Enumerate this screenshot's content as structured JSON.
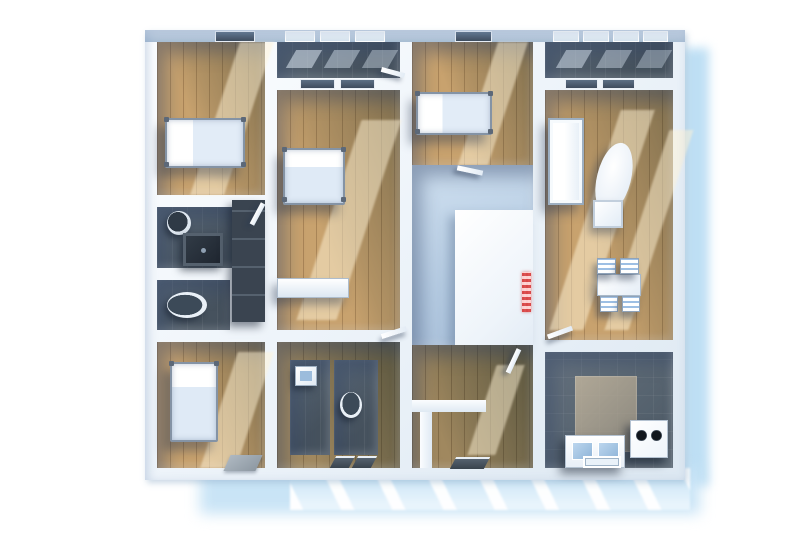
{
  "scene": {
    "kind": "3d-floor-plan-render",
    "view": "top-down perspective",
    "description": "Architectural 3D rendering of an apartment floor plan with white walls, wooden floors, dark tiled bathrooms and a soft blue drop shadow on white background"
  },
  "palette": {
    "background": "#ffffff",
    "drop_shadow": "#bedff4",
    "terrace": "#c9e4f6",
    "walls": "#eef4fa",
    "wall_face": "#b0c3d8",
    "wood_floor": "#c8a26e",
    "wood_floor_shadow": "#8b7f5e",
    "bathroom_floor": "#4e5b68",
    "hall_floor": "#b5cbe2",
    "kitchen_floor": "#5a6874",
    "window_dark": "#46566a",
    "window_bright": "#e6eef6",
    "accent_red": "#d63c3c",
    "furniture_white": "#f5f9fe",
    "mattress_blue": "#dce9f6"
  },
  "rooms": [
    {
      "name": "bedroom top-left",
      "floor": "wood",
      "furniture": [
        "single bed",
        "window"
      ]
    },
    {
      "name": "bathroom left",
      "floor": "dark tile",
      "furniture": [
        "round washbasin",
        "shower tray"
      ]
    },
    {
      "name": "wc left",
      "floor": "dark tile",
      "furniture": [
        "toilet"
      ]
    },
    {
      "name": "wardrobe closet",
      "floor": "dark",
      "furniture": [
        "built-in closet"
      ]
    },
    {
      "name": "bedroom bottom-left",
      "floor": "wood",
      "furniture": [
        "single bed",
        "doormat"
      ]
    },
    {
      "name": "balcony strip middle",
      "floor": "dark",
      "furniture": [
        "window band"
      ]
    },
    {
      "name": "bedroom middle",
      "floor": "wood",
      "furniture": [
        "double bed",
        "low cabinet",
        "two windows"
      ]
    },
    {
      "name": "inner bathrooms",
      "floor": "dark tile",
      "furniture": [
        "square washbasin",
        "toilet",
        "floor windows"
      ]
    },
    {
      "name": "bedroom center",
      "floor": "wood",
      "furniture": [
        "single bed",
        "window"
      ]
    },
    {
      "name": "central hall",
      "floor": "pale blue",
      "furniture": [
        "white platform",
        "red checkered wall strip"
      ]
    },
    {
      "name": "corridor south",
      "floor": "wood",
      "furniture": [
        "doors",
        "floor window"
      ]
    },
    {
      "name": "living dining right",
      "floor": "wood",
      "furniture": [
        "tall wardrobe",
        "oval table",
        "stool",
        "dining table with four chairs",
        "loggia windows"
      ]
    },
    {
      "name": "kitchen",
      "floor": "dark tile with beige patch",
      "furniture": [
        "cooker with two burners",
        "island with double sink",
        "wall sink",
        "bottom window"
      ]
    },
    {
      "name": "terrace",
      "floor": "light blue",
      "furniture": []
    }
  ]
}
